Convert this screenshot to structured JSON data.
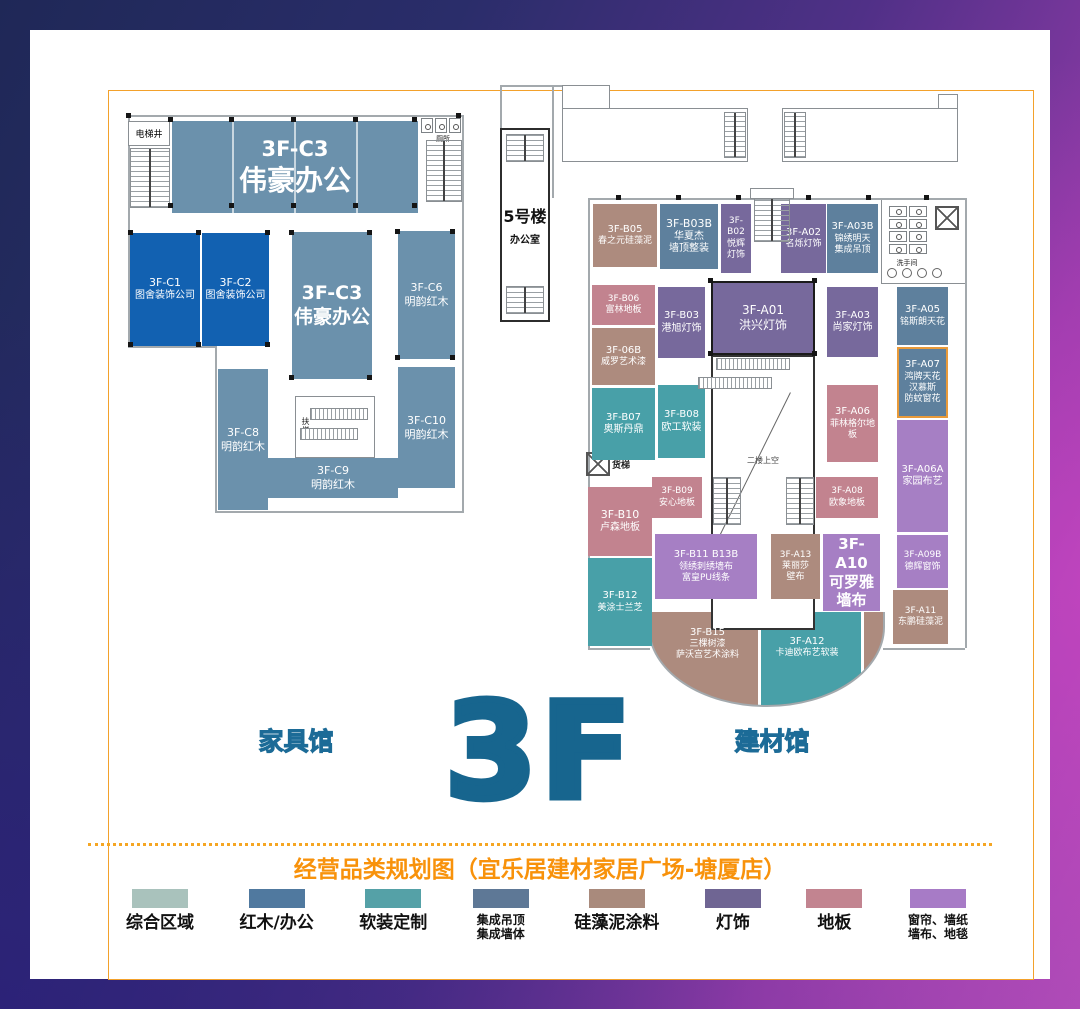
{
  "footer": {
    "left_hall": "家具馆",
    "right_hall": "建材馆",
    "floor": "3F",
    "caption": "经营品类规划图（宜乐居建材家居广场-塘厦店）"
  },
  "palette": {
    "accent_orange": "#f8920b",
    "floor_blue": "#17658e",
    "office_blue": "#6b91ac",
    "company_blue": "#1261b1",
    "ceiling_slate": "#5e809d",
    "teal": "#48a0a8",
    "tan": "#ad8b7e",
    "lamp_purple": "#77699c",
    "floorboard_pink": "#c2838f",
    "curtain_purple": "#a67fc4"
  },
  "legend": {
    "items": [
      {
        "label": "综合区域",
        "color": "#a9c2bc"
      },
      {
        "label": "红木/办公",
        "color": "#50799f"
      },
      {
        "label": "软装定制",
        "color": "#55a1a7"
      },
      {
        "label": "集成吊顶\n集成墙体",
        "color": "#5e7896"
      },
      {
        "label": "硅藻泥涂料",
        "color": "#a98a7c"
      },
      {
        "label": "灯饰",
        "color": "#6f6593"
      },
      {
        "label": "地板",
        "color": "#c28490"
      },
      {
        "label": "窗帘、墙纸\n墙布、地毯",
        "color": "#a77bc6"
      }
    ]
  },
  "plan": {
    "tower": {
      "name": "5号楼",
      "use": "办公室"
    },
    "labels": {
      "elevator_shaft": "电梯井",
      "toilet": "厕所",
      "escalator": "扶梯",
      "freight_elevator": "货梯",
      "atrium_void": "二楼上空",
      "restroom": "洗手间"
    },
    "units": {
      "c3_top": {
        "id": "3F-C3",
        "name": "伟豪办公"
      },
      "c1": {
        "id": "3F-C1",
        "name": "图舍装饰公司"
      },
      "c2": {
        "id": "3F-C2",
        "name": "图舍装饰公司"
      },
      "c3_mid": {
        "id": "3F-C3",
        "name": "伟豪办公"
      },
      "c6": {
        "id": "3F-C6",
        "name": "明韵红木"
      },
      "c8": {
        "id": "3F-C8",
        "name": "明韵红木"
      },
      "c10": {
        "id": "3F-C10",
        "name": "明韵红木"
      },
      "c9": {
        "id": "3F-C9",
        "name": "明韵红木"
      },
      "b05": {
        "id": "3F-B05",
        "name": "春之元硅藻泥"
      },
      "b03b": {
        "id": "3F-B03B",
        "name": "华夏杰\n墙顶整装"
      },
      "b02": {
        "id": "3F-\nB02",
        "name": "悦辉\n灯饰"
      },
      "a02": {
        "id": "3F-A02",
        "name": "名烁灯饰"
      },
      "a03b": {
        "id": "3F-A03B",
        "name": "锦绣明天\n集成吊顶"
      },
      "b06": {
        "id": "3F-B06",
        "name": "富林地板"
      },
      "b03": {
        "id": "3F-B03",
        "name": "港旭灯饰"
      },
      "a01": {
        "id": "3F-A01",
        "name": "洪兴灯饰"
      },
      "a03": {
        "id": "3F-A03",
        "name": "尚家灯饰"
      },
      "a05": {
        "id": "3F-A05",
        "name": "铭斯朗天花"
      },
      "b06b": {
        "id": "3F-06B",
        "name": "威罗艺术漆"
      },
      "a07": {
        "id": "3F-A07",
        "name": "鸿牌天花\n汉慕斯\n防蚊窗花"
      },
      "b07": {
        "id": "3F-B07",
        "name": "奥斯丹鼎"
      },
      "b08": {
        "id": "3F-B08",
        "name": "欧工软装"
      },
      "a06": {
        "id": "3F-A06",
        "name": "菲林格尔地板"
      },
      "a06a": {
        "id": "3F-A06A",
        "name": "家园布艺"
      },
      "b09": {
        "id": "3F-B09",
        "name": "安心地板"
      },
      "a08": {
        "id": "3F-A08",
        "name": "欧象地板"
      },
      "b10": {
        "id": "3F-B10",
        "name": "卢森地板"
      },
      "b11": {
        "id": "3F-B11 B13B",
        "name": "领绣刺绣墙布\n富皇PU线条"
      },
      "a13": {
        "id": "3F-A13",
        "name": "莱丽莎\n壁布"
      },
      "a10": {
        "id": "3F-A10",
        "name": "可罗雅\n墙布"
      },
      "a09b": {
        "id": "3F-A09B",
        "name": "德辉窗饰"
      },
      "b12": {
        "id": "3F-B12",
        "name": "美涂士兰芝"
      },
      "a11": {
        "id": "3F-A11",
        "name": "东鹏硅藻泥"
      },
      "b15": {
        "id": "3F-B15",
        "name": "三棵树漆\n萨沃宫艺术涂料"
      },
      "a12": {
        "id": "3F-A12",
        "name": "卡迪欧布艺软装"
      }
    }
  }
}
